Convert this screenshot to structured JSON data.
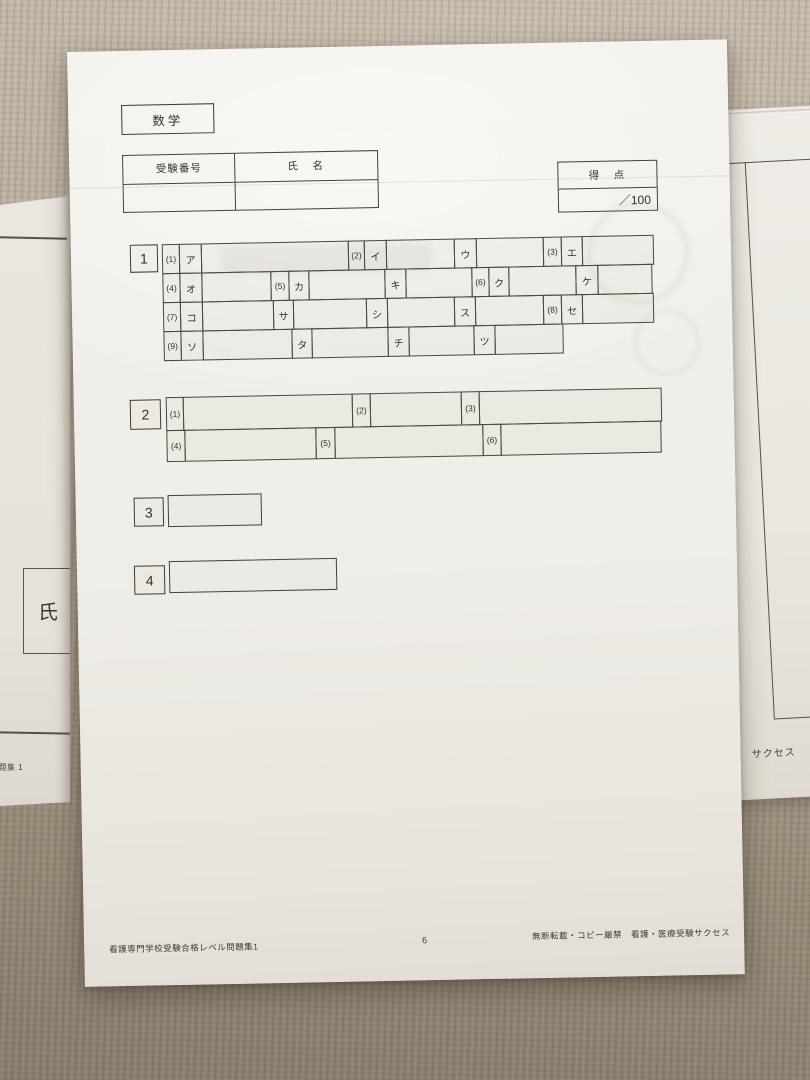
{
  "answer_sheet": {
    "subject": "数学",
    "header": {
      "exam_number_label": "受験番号",
      "name_label": "氏　名"
    },
    "score": {
      "label": "得　点",
      "value": "／100"
    },
    "q1": {
      "number": "1",
      "row_heights": [
        30,
        30,
        30,
        30
      ],
      "rows": [
        [
          {
            "t": "num",
            "label": "(1)",
            "w": 18
          },
          {
            "t": "kana",
            "label": "ア",
            "w": 23
          },
          {
            "t": "blank",
            "w": 148
          },
          {
            "t": "num",
            "label": "(2)",
            "w": 17
          },
          {
            "t": "kana",
            "label": "イ",
            "w": 23
          },
          {
            "t": "blank",
            "w": 69
          },
          {
            "t": "kana",
            "label": "ウ",
            "w": 23
          },
          {
            "t": "blank",
            "w": 68
          },
          {
            "t": "num",
            "label": "(3)",
            "w": 19
          },
          {
            "t": "kana",
            "label": "エ",
            "w": 22
          },
          {
            "t": "blank",
            "w": 72
          }
        ],
        [
          {
            "t": "num",
            "label": "(4)",
            "w": 18
          },
          {
            "t": "kana",
            "label": "オ",
            "w": 23
          },
          {
            "t": "blank",
            "w": 70
          },
          {
            "t": "num",
            "label": "(5)",
            "w": 19
          },
          {
            "t": "kana",
            "label": "カ",
            "w": 21
          },
          {
            "t": "blank",
            "w": 77
          },
          {
            "t": "kana",
            "label": "キ",
            "w": 22
          },
          {
            "t": "blank",
            "w": 67
          },
          {
            "t": "num",
            "label": "(6)",
            "w": 18
          },
          {
            "t": "kana",
            "label": "ク",
            "w": 21
          },
          {
            "t": "blank",
            "w": 68
          },
          {
            "t": "kana",
            "label": "ケ",
            "w": 23
          },
          {
            "t": "blank",
            "w": 55
          }
        ],
        [
          {
            "t": "num",
            "label": "(7)",
            "w": 18
          },
          {
            "t": "kana",
            "label": "コ",
            "w": 23
          },
          {
            "t": "blank",
            "w": 72
          },
          {
            "t": "kana",
            "label": "サ",
            "w": 21
          },
          {
            "t": "blank",
            "w": 74
          },
          {
            "t": "kana",
            "label": "シ",
            "w": 22
          },
          {
            "t": "blank",
            "w": 68
          },
          {
            "t": "kana",
            "label": "ス",
            "w": 22
          },
          {
            "t": "blank",
            "w": 69
          },
          {
            "t": "num",
            "label": "(8)",
            "w": 19
          },
          {
            "t": "kana",
            "label": "セ",
            "w": 22
          },
          {
            "t": "blank",
            "w": 72
          }
        ],
        [
          {
            "t": "num",
            "label": "(9)",
            "w": 18
          },
          {
            "t": "kana",
            "label": "ソ",
            "w": 23
          },
          {
            "t": "blank",
            "w": 90
          },
          {
            "t": "kana",
            "label": "タ",
            "w": 21
          },
          {
            "t": "blank",
            "w": 77
          },
          {
            "t": "kana",
            "label": "チ",
            "w": 22
          },
          {
            "t": "blank",
            "w": 66
          },
          {
            "t": "kana",
            "label": "ツ",
            "w": 22
          },
          {
            "t": "blank",
            "w": 69
          }
        ]
      ]
    },
    "q2": {
      "number": "2",
      "row_heights": [
        34,
        32
      ],
      "rows": [
        [
          {
            "t": "num",
            "label": "(1)",
            "w": 18
          },
          {
            "t": "blank",
            "w": 170
          },
          {
            "t": "num",
            "label": "(2)",
            "w": 19
          },
          {
            "t": "blank",
            "w": 92
          },
          {
            "t": "num",
            "label": "(3)",
            "w": 19
          },
          {
            "t": "blank",
            "w": 183
          }
        ],
        [
          {
            "t": "num",
            "label": "(4)",
            "w": 19
          },
          {
            "t": "blank",
            "w": 132
          },
          {
            "t": "num",
            "label": "(5)",
            "w": 20
          },
          {
            "t": "blank",
            "w": 149
          },
          {
            "t": "num",
            "label": "(6)",
            "w": 19
          },
          {
            "t": "blank",
            "w": 161
          }
        ]
      ]
    },
    "q3": {
      "number": "3"
    },
    "q4": {
      "number": "4"
    },
    "footer": {
      "left": "看護専門学校受験合格レベル問題集1",
      "page": "6",
      "right": "無断転載・コピー厳禁　看護・医療受験サクセス"
    }
  },
  "background": {
    "left_paper": {
      "name_label": "氏",
      "bottom_text": "問題集 1"
    },
    "right_paper": {
      "text": "サクセス"
    }
  },
  "colors": {
    "carpet": "#ab9f8f",
    "paper": "#f1efea",
    "line": "#4b4741"
  }
}
